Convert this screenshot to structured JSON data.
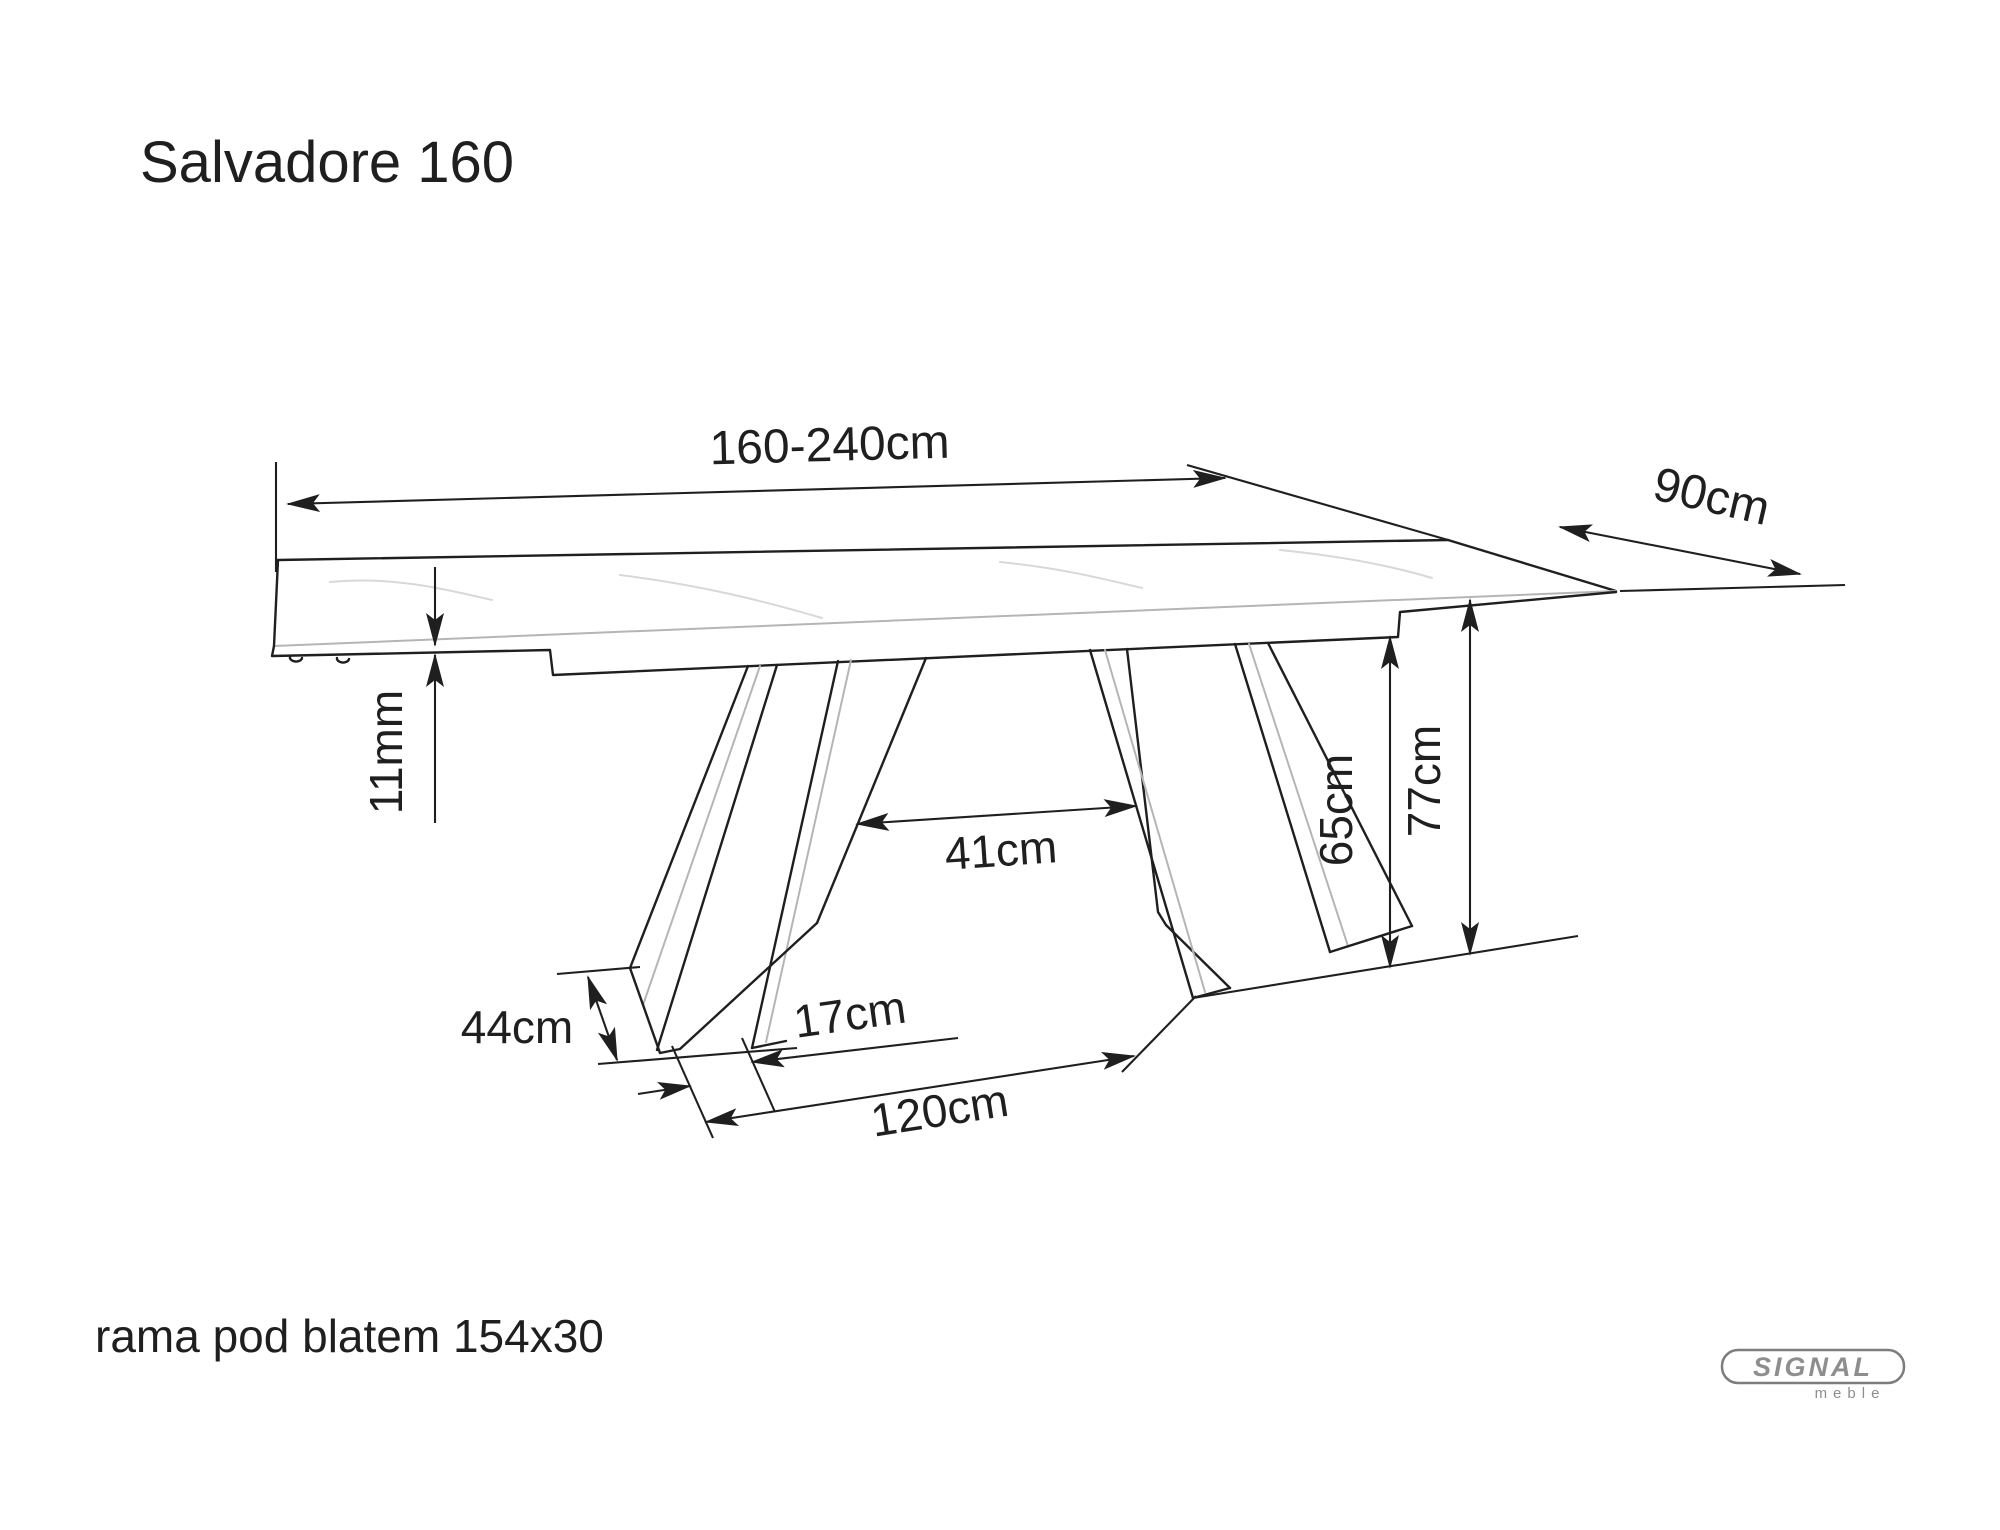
{
  "title": "Salvadore 160",
  "note": "rama pod blatem 154x30",
  "dimensions": {
    "length": "160-240cm",
    "depth": "90cm",
    "top_thickness": "11mm",
    "legs_inner_span": "41cm",
    "frame_height": "65cm",
    "table_height": "77cm",
    "foot_depth": "44cm",
    "foot_width": "17cm",
    "base_span": "120cm"
  },
  "logo": {
    "brand": "SIGNAL",
    "sub": "meble"
  },
  "colors": {
    "ink": "#1f1f1f",
    "soft_line": "#b5b5b5",
    "vein": "#d8d8d8",
    "logo_gray": "#8e8e8e",
    "background": "#ffffff"
  }
}
